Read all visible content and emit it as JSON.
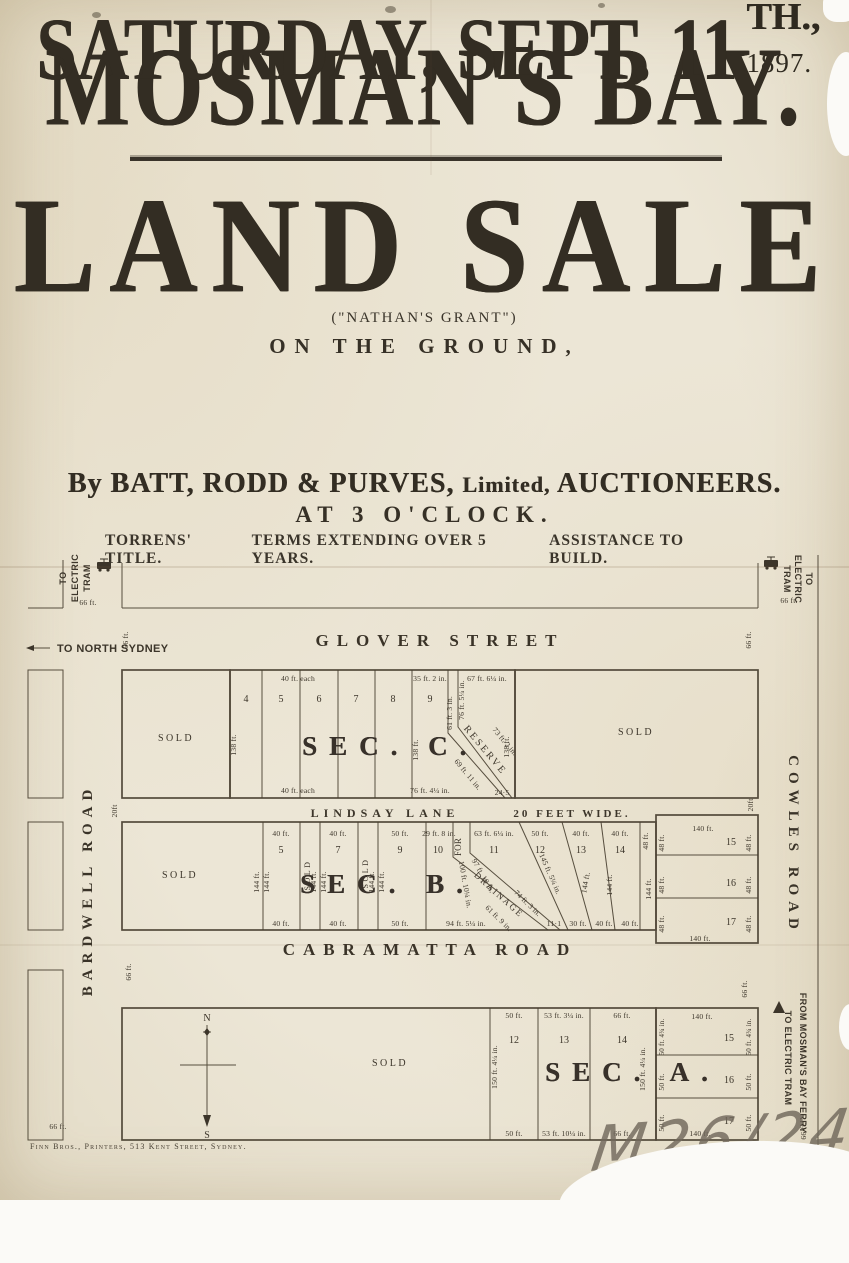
{
  "poster": {
    "title": "MOSMAN'S BAY.",
    "headline": "LAND SALE",
    "grant": "(\"NATHAN'S GRANT\")",
    "on_ground": "ON THE GROUND,",
    "date_main": "SATURDAY, SEPT. 11",
    "date_sup": "TH.,",
    "date_year": "1897.",
    "by_pre": "By BATT, RODD & PURVES,",
    "by_mid": "Limited,",
    "by_post": "AUCTIONEERS.",
    "time": "AT 3 O'CLOCK.",
    "terms": [
      "TORRENS' TITLE.",
      "TERMS EXTENDING OVER 5 YEARS.",
      "ASSISTANCE TO BUILD."
    ]
  },
  "map": {
    "streets": {
      "glover": "GLOVER STREET",
      "lindsay": "LINDSAY LANE",
      "lindsay_width": "20 FEET WIDE.",
      "cabramatta": "CABRAMATTA ROAD",
      "bardwell": "BARDWELL ROAD",
      "cowles": "COWLES ROAD"
    },
    "corners": {
      "tram_words": [
        "TO",
        "ELECTRIC",
        "TRAM"
      ],
      "north_sydney": "TO NORTH SYDNEY",
      "ferry": "FROM MOSMAN'S BAY FERRY",
      "ferry_tram": "TO ELECTRIC TRAM"
    },
    "common": {
      "ft66": "66 ft.",
      "ft144": "144 ft.",
      "ft138": "138 ft.",
      "ft48": "48 ft.",
      "ft140": "140 ft.",
      "ft20": "20ft",
      "sold": "SOLD",
      "n": "N",
      "s": "S"
    },
    "sec_c": {
      "label": "SEC. C.",
      "lots": [
        "4",
        "5",
        "6",
        "7",
        "8",
        "9"
      ],
      "each40": "40 ft. each",
      "lot9_top": "35 ft. 2 in.",
      "lot9_bottom": "76 ft. 4¼ in.",
      "right61": "61 ft. 3 in.",
      "res_left": "76 ft. 5¼ in.",
      "res_top": "67 ft. 6¼ in.",
      "reserve": "RESERVE",
      "d73": "73 ft. 2 in.",
      "d69": "69 ft. 11 in.",
      "b245": "24·5"
    },
    "sec_b": {
      "label": "SEC. B.",
      "lots": [
        "5",
        "7",
        "9",
        "10",
        "11",
        "12",
        "13",
        "14"
      ],
      "top": [
        "40 ft.",
        "40 ft.",
        "50 ft.",
        "29 ft. 8 in.",
        "63 ft. 6¼ in.",
        "50 ft.",
        "40 ft.",
        "40 ft."
      ],
      "bottom": [
        "40 ft.",
        "40 ft.",
        "50 ft.",
        "94 ft. 5¼ in.",
        "11·1",
        "30 ft.",
        "40 ft.",
        "40 ft."
      ],
      "for_word": "FOR",
      "drainage": "DRAINAGE",
      "d100": "100 ft. 10¼ in.",
      "d97": "97 ft. 10 in.",
      "d74": "74 ft. 3 in.",
      "d61": "61 ft. 9 in.",
      "slant145": "145 ft. 5¼ in.",
      "col": [
        "15",
        "16",
        "17"
      ]
    },
    "sec_a": {
      "label": "SEC. A.",
      "lots": [
        "12",
        "13",
        "14"
      ],
      "top": [
        "50 ft.",
        "53 ft. 3¼ in.",
        "66 ft."
      ],
      "bottom": [
        "50 ft.",
        "53 ft. 10¼ in.",
        "66 ft."
      ],
      "depth": "150 ft. 4¼ in.",
      "col": [
        "15",
        "16",
        "17"
      ],
      "col_row1": "50 ft. 4¾ in.",
      "col_side": "50 ft."
    }
  },
  "footer": {
    "printer": "Finn Bros., Printers, 513 Kent Street, Sydney.",
    "mark": "M26/245"
  }
}
